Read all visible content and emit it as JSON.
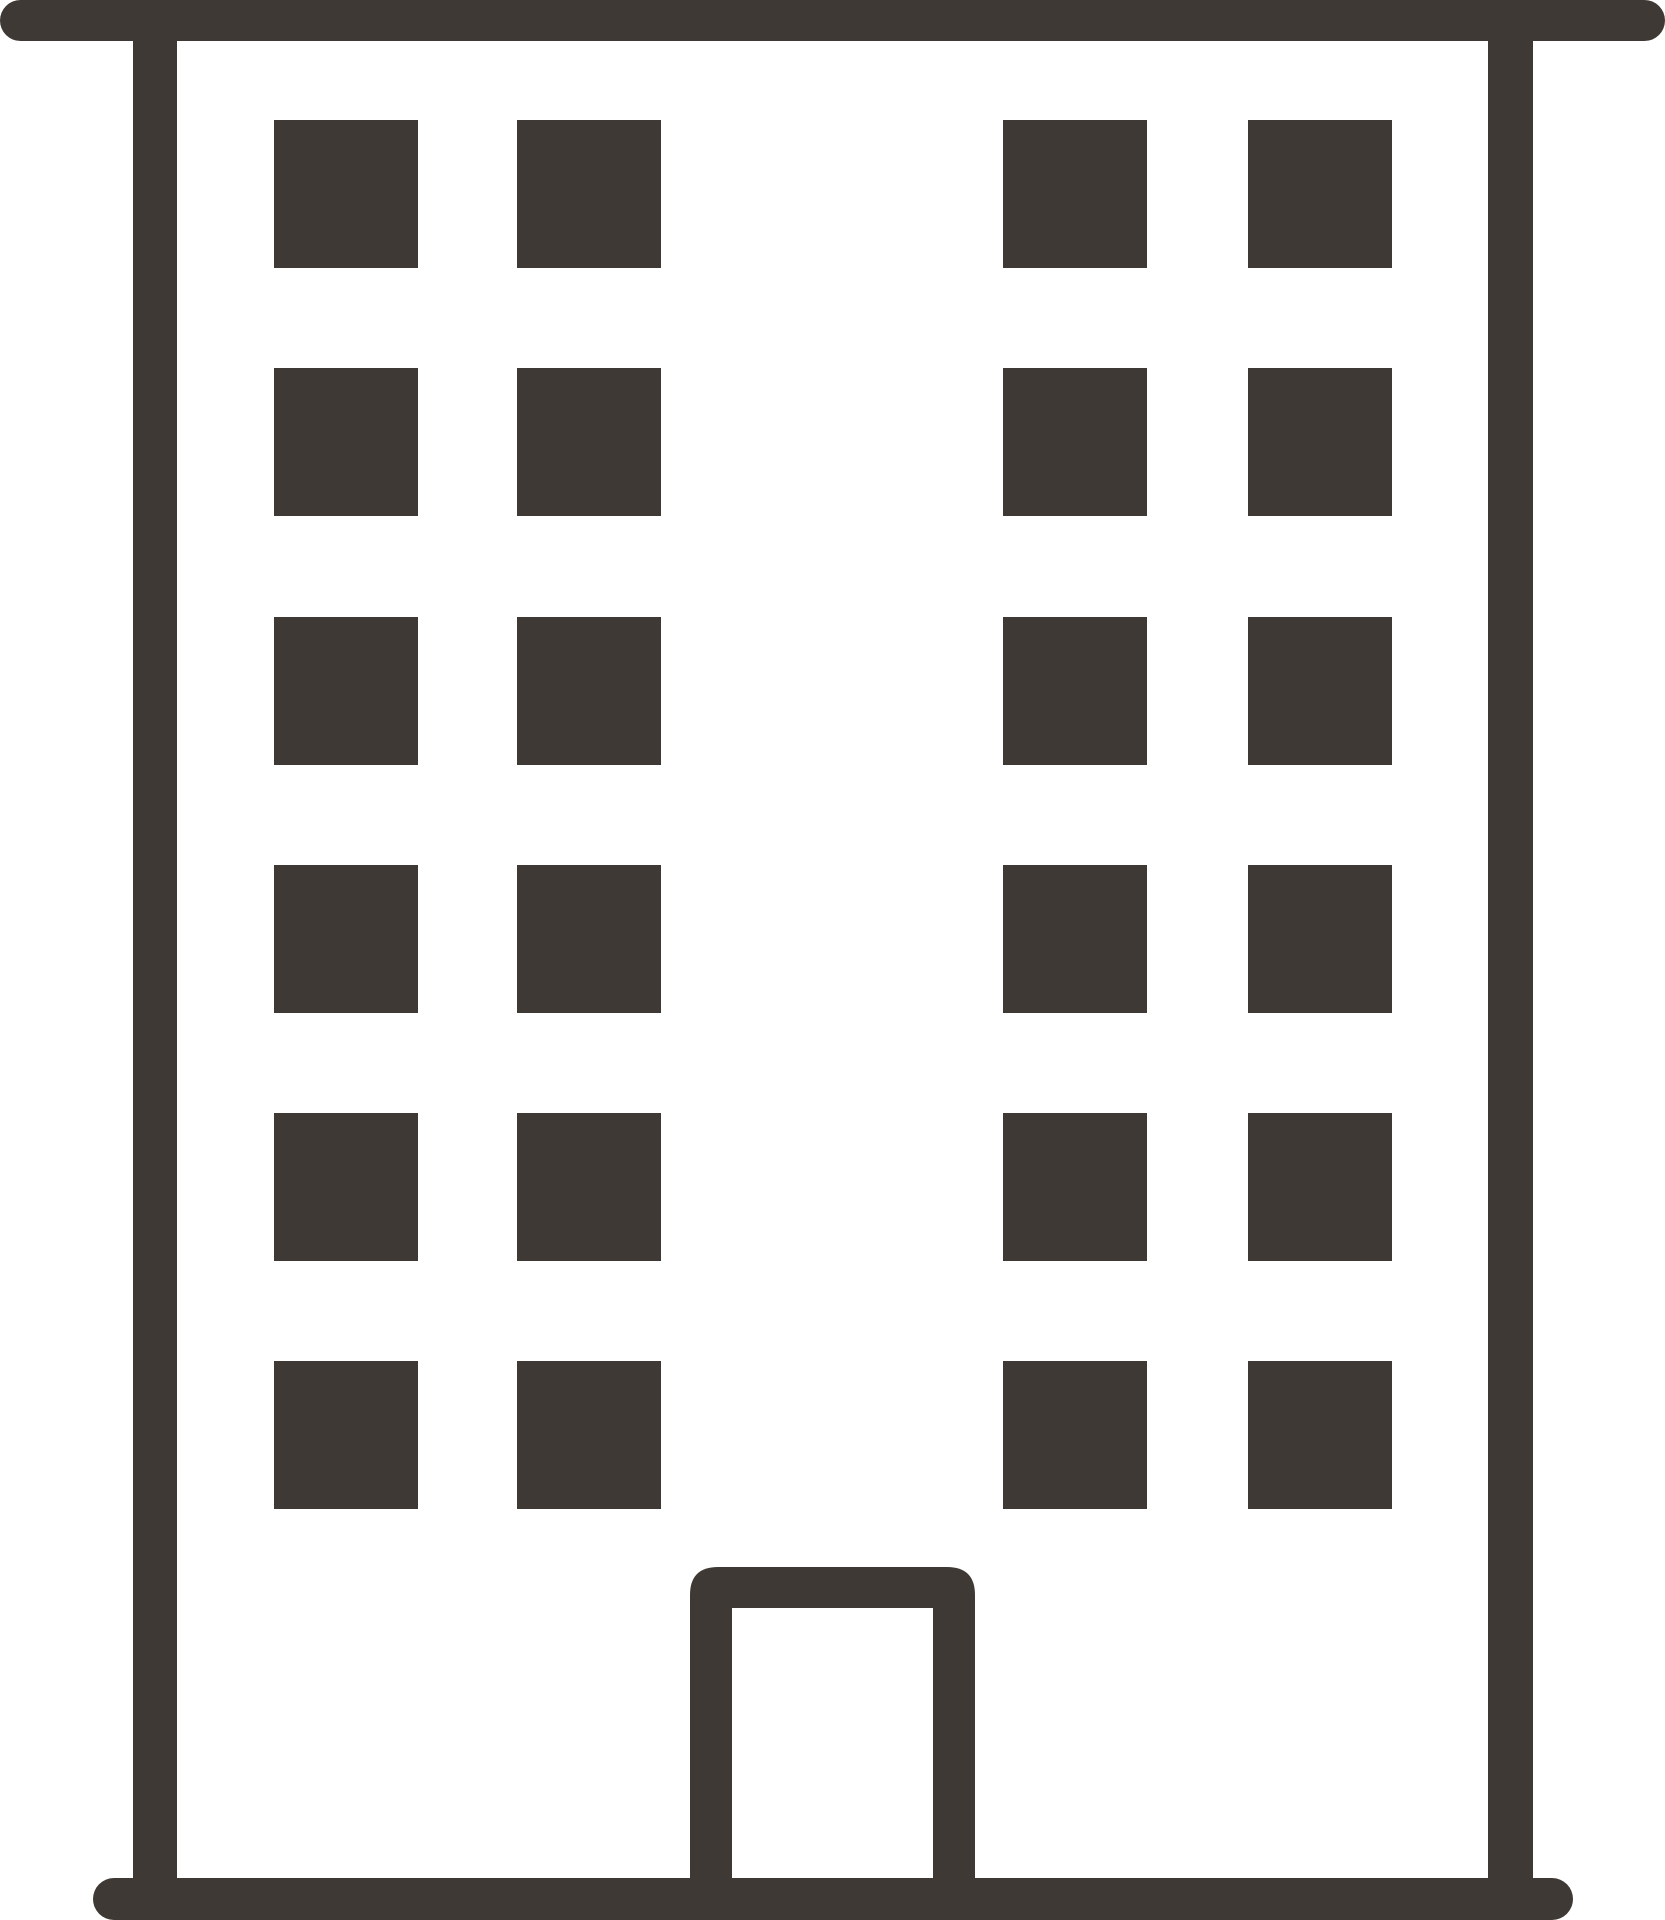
{
  "icon": {
    "name": "building-icon",
    "foreground_color": "#3E3934",
    "background_color": "#FFFFFF",
    "canvas": {
      "width": 1665,
      "height": 1920
    },
    "roof_bar": {
      "x_start": 0,
      "x_end": 1665,
      "y": 0,
      "height": 41
    },
    "base_bar": {
      "x_start": 93,
      "x_end": 1573,
      "y": 1878,
      "height": 42
    },
    "left_wall": {
      "x": 133,
      "width": 44
    },
    "right_wall": {
      "x": 1488,
      "width": 45
    },
    "windows": {
      "rows": 6,
      "columns": 4,
      "col_x": [
        274,
        517,
        1003,
        1248
      ],
      "row_y": [
        120,
        368,
        617,
        865,
        1113,
        1361
      ],
      "width": 144,
      "height": 148
    },
    "door": {
      "outer_x": 690,
      "outer_width": 285,
      "top_y": 1567,
      "corner_radius": 28,
      "inner_x": 732,
      "inner_width": 201,
      "inner_top_y": 1608
    }
  }
}
